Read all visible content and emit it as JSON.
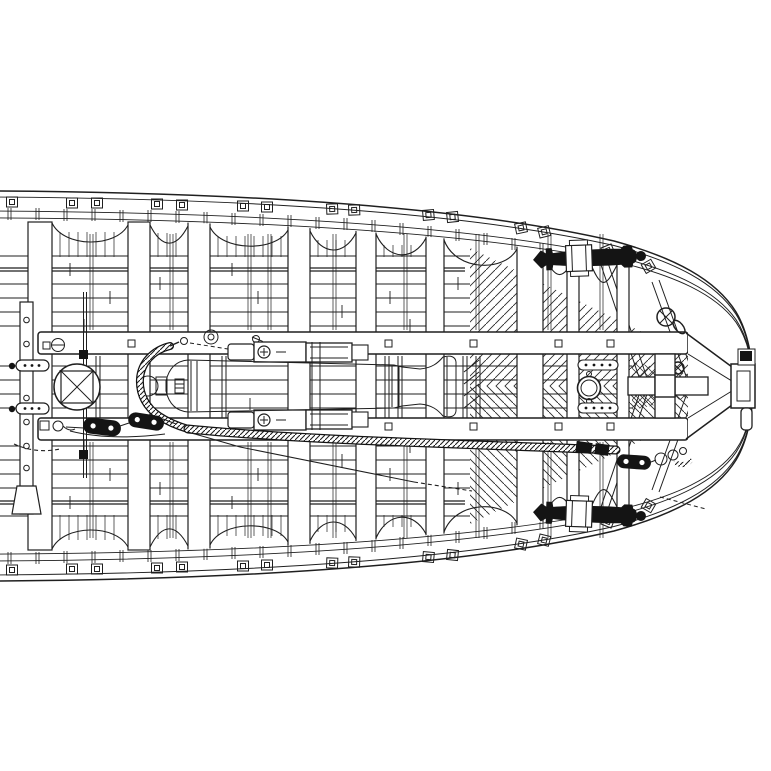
{
  "title": "warship-bow-deck-plan-drawing",
  "colors": {
    "paper": "#ffffff",
    "ink": "#1f1f1f",
    "fill_dark": "#141414",
    "barrel_base": "#8e8e8e",
    "hatch_line": "#2a2a2a"
  },
  "parts": {
    "hull": "hull-outline",
    "gunwale_top": "top-gunwale-band",
    "gunwale_bottom": "bottom-gunwale-band",
    "deck": "deck-planking",
    "beams": "deck-beams",
    "rail_top": "gun-slide-rail-top",
    "rail_bottom": "gun-slide-rail-bottom",
    "cannon": "pivot-cannon",
    "carriage": "gun-carriage",
    "rope": "breeching-rope",
    "tackle_left": "train-tackle-left",
    "tackle_bow": "train-tackle-bow",
    "stowed_gun_top": "stowed-gun-silhouette-top",
    "stowed_gun_bottom": "stowed-gun-silhouette-bottom",
    "bitts": "bow-bitts",
    "stem": "stem-fitting",
    "fairlead": "fairlead-cross-ring",
    "hatch": "deck-ring-hatch"
  }
}
